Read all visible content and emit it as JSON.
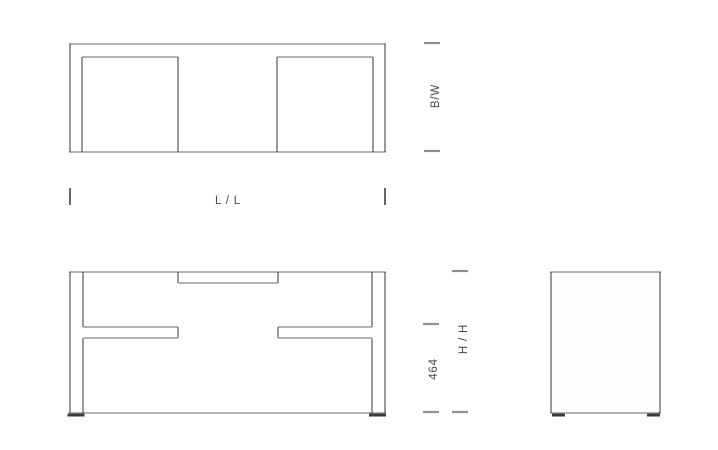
{
  "dimensions": {
    "width_depth": {
      "label": "B/W"
    },
    "length": {
      "label": "L / L"
    },
    "height": {
      "label": "H / H"
    },
    "underframe_height": {
      "label": "464"
    }
  },
  "colors": {
    "background": "#ffffff",
    "line_horizontal": "#9a9a9a",
    "line_vertical": "#343434",
    "tick_horizontal": "#8f8f8f",
    "tick_vertical": "#333333",
    "label_text": "#4a4a4a",
    "foot": "#3a3a3a",
    "side_panel_fill": "#fefefc"
  }
}
